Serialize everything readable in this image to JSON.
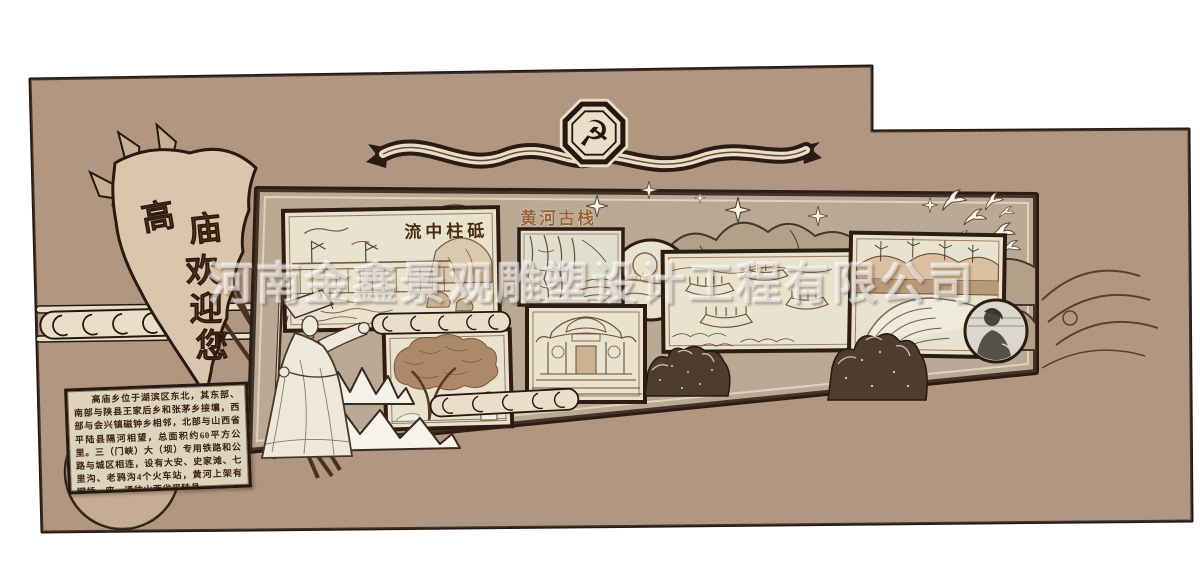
{
  "company_watermark": "河南金鑫景观雕塑设计工程有限公司",
  "welcome_flag": {
    "line": "高庙欢迎您",
    "chars": [
      "高",
      "庙",
      "欢",
      "迎",
      "您"
    ]
  },
  "party_emblem": {
    "symbol": "☭"
  },
  "gallery": {
    "dam_caption": "流中柱砥",
    "plank_road_title": "黄河古栈"
  },
  "intro": {
    "text": "高庙乡位于湖滨区东北，其东部、南部与陕县王家后乡和张茅乡接壤，西部与会兴镇磁钟乡相邻，北部与山西省平陆县隔河相望，总面积约60平方公里。三（门峡）大（坝）专用铁路和公路与城区相连，设有大安、史家滩、七里沟、老鸦沟4个火车站，黄河上架有钢桥一座，通往山西省平陆县。"
  },
  "colors": {
    "wall": "#a78a74",
    "panel": "#b2a08b",
    "paper": "#e9e2cf",
    "frame_dark": "#2e1c12",
    "accent_brown": "#7a4a28",
    "ink": "#4a2c12",
    "cream": "#e9dfc8"
  }
}
